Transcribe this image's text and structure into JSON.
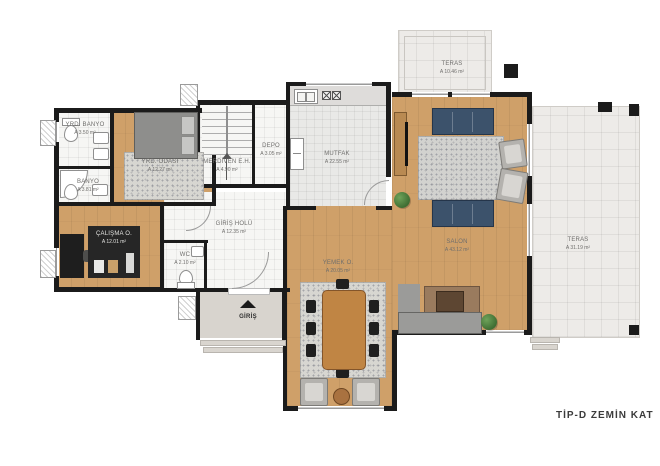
{
  "title": "TİP-D  ZEMİN KAT",
  "entrance": {
    "label": "GİRİŞ"
  },
  "rooms": {
    "yrdBanyo": {
      "name": "YRD. BANYO",
      "area": "A 3.50 m²"
    },
    "banyo": {
      "name": "BANYO",
      "area": "A 3.81 m²"
    },
    "yrdOdasi": {
      "name": "YRD. ODASI",
      "area": "A 12.27 m²"
    },
    "calisma": {
      "name": "ÇALIŞMA O.",
      "area": "A 12.01 m²"
    },
    "merdiven": {
      "name": "MERDİVEN E.H.",
      "area": "A 4.90 m²"
    },
    "depo": {
      "name": "DEPO",
      "area": "A 3.05 m²"
    },
    "mutfak": {
      "name": "MUTFAK",
      "area": "A 22.55 m²"
    },
    "girisHolu": {
      "name": "GİRİŞ HOLÜ",
      "area": "A 12.35 m²"
    },
    "wc": {
      "name": "WC",
      "area": "A 2.10 m²"
    },
    "yemek": {
      "name": "YEMEK O.",
      "area": "A 20.05 m²"
    },
    "salon": {
      "name": "SALON",
      "area": "A 43.12 m²"
    },
    "terasTop": {
      "name": "TERAS",
      "area": "A 10.46 m²"
    },
    "terasRight": {
      "name": "TERAS",
      "area": "A 31.19 m²"
    }
  },
  "colors": {
    "wall": "#1b1b1b",
    "wood": "#cfa069",
    "tile": "#f6f6f4",
    "ktile": "#e9e9e7",
    "teras": "#edebe8",
    "rug": "#d7d6d1",
    "navy": "#3c526b",
    "porch": "#d8d4ce",
    "graySofa": "#9b9b99",
    "brownRug": "#9a7b5e"
  }
}
